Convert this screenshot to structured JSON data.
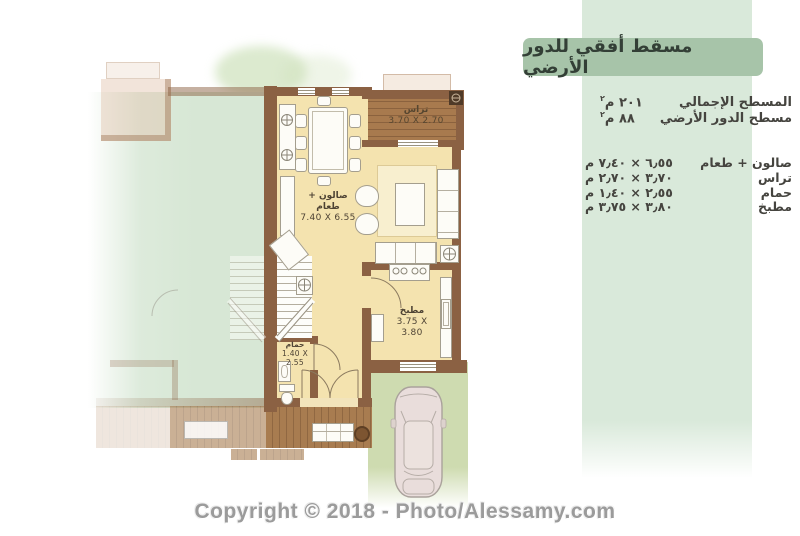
{
  "watermark": "Copyright © 2018 - Photo/Alessamy.com",
  "panel": {
    "title": "مسقط أفقي للدور الأرضي",
    "areas": [
      {
        "label": "المسطح الإجمالي",
        "value": "٢٠١",
        "unit": "م",
        "sup": "٢"
      },
      {
        "label": "مسطح الدور الأرضي",
        "value": "٨٨",
        "unit": "م",
        "sup": "٢"
      }
    ],
    "rooms": [
      {
        "label": "صالون + طعام",
        "value": "٦٫٥٥ × ٧٫٤٠ م"
      },
      {
        "label": "تراس",
        "value": "٣٫٧٠ × ٢٫٧٠ م"
      },
      {
        "label": "حمام",
        "value": "٢٫٥٥ × ١٫٤٠ م"
      },
      {
        "label": "مطبخ",
        "value": "٣٫٨٠ × ٣٫٧٥ م"
      }
    ]
  },
  "plan": {
    "terrace": {
      "name": "تراس",
      "dims": "3.70 X 2.70"
    },
    "salon": {
      "name": "صالون + طعام",
      "dims": "7.40 X 6.55"
    },
    "kitchen": {
      "name": "مطبخ",
      "dims": "3.75 X 3.80"
    },
    "bath": {
      "name": "حمام",
      "dims": "1.40 X 2.55"
    }
  },
  "colors": {
    "header_green": "#a7c4a9",
    "panel_strip_green": "#d9e9da",
    "wall_brown": "#8b6143",
    "deck_brown": "#a87a4e",
    "floor_cream": "#f4e3af",
    "neighbor_mint": "#d7e7d5",
    "lawn_green": "#cedbb0"
  }
}
